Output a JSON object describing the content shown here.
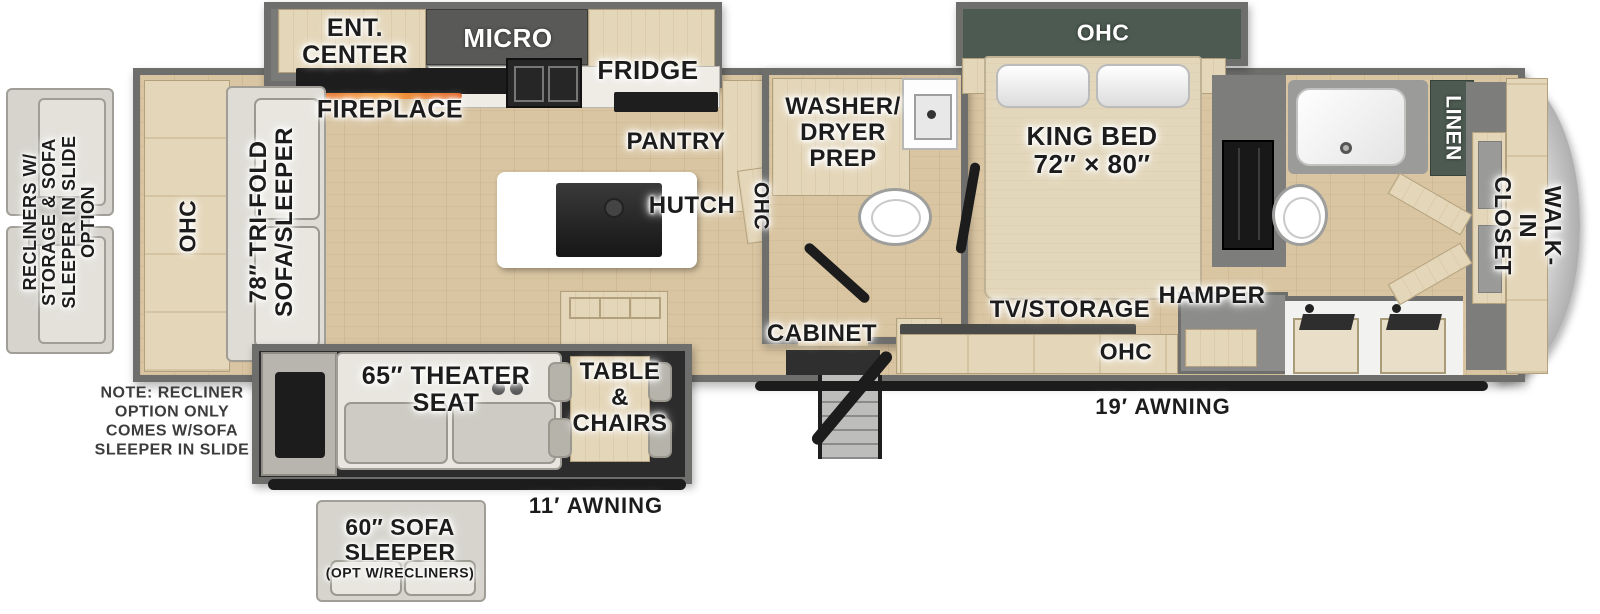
{
  "floorplan": {
    "labels": {
      "ent_center": "ENT.\nCENTER",
      "fireplace": "FIREPLACE",
      "micro": "MICRO",
      "fridge": "FRIDGE",
      "pantry": "PANTRY",
      "hutch": "HUTCH",
      "kitchen_ohc": "OHC",
      "washer_dryer_prep": "WASHER/\nDRYER\nPREP",
      "cabinet": "CABINET",
      "bedroom_ohc": "OHC",
      "king_bed": "KING BED\n72″ × 80″",
      "tv_storage": "TV/STORAGE",
      "hamper": "HAMPER",
      "dresser_ohc": "OHC",
      "linen": "LINEN",
      "walk_in_closet": "WALK-IN CLOSET",
      "rear_ohc": "OHC",
      "trifold_sofa": "78″ TRI-FOLD\nSOFA/SLEEPER",
      "theater_seat": "65″ THEATER\nSEAT",
      "table_chairs": "TABLE\n&\nCHAIRS",
      "awning_19": "19′ AWNING",
      "awning_11": "11′ AWNING"
    },
    "options": {
      "recliner_slide_option": "RECLINERS W/\nSTORAGE & SOFA\nSLEEPER IN SLIDE\nOPTION",
      "note": "NOTE: RECLINER\nOPTION ONLY\nCOMES W/SOFA\nSLEEPER IN SLIDE",
      "sofa_sleeper": "60″ SOFA\nSLEEPER",
      "sofa_sleeper_note": "(OPT W/RECLINERS)"
    },
    "colors": {
      "floor_wood": "#d9c5a1",
      "cabinet_wood": "#e4d6b8",
      "wall_gray": "#6e6e6c",
      "dark_green": "#4c5a51",
      "dark_cabinet": "#595957",
      "black": "#1c1c1c",
      "sofa_gray": "#dedcd5",
      "fireplace_glow": "#e05a1a"
    }
  }
}
